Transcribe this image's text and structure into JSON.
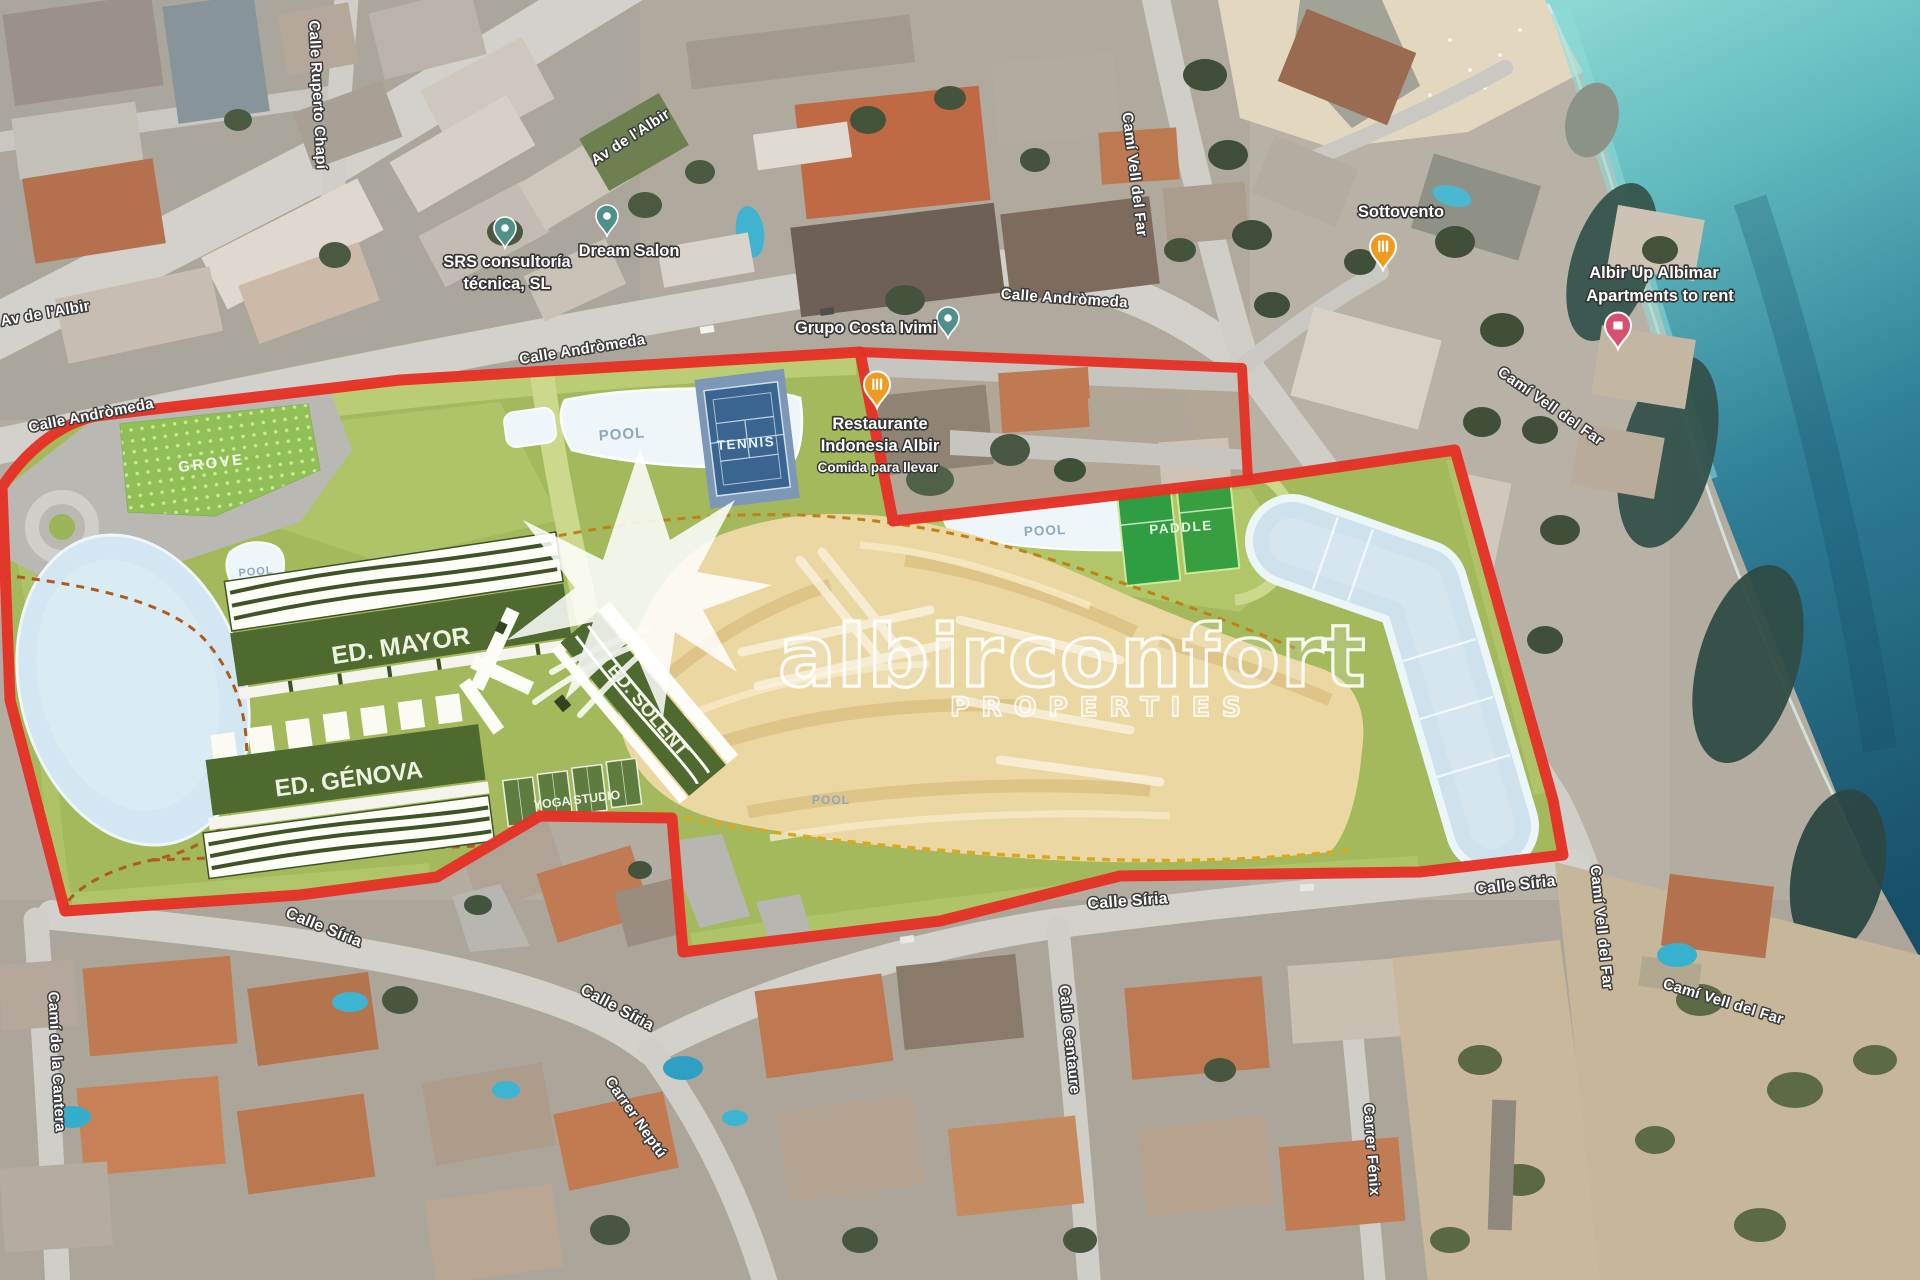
{
  "brand": {
    "word1": "albir",
    "word2": "confort",
    "tagline": "PROPERTIES"
  },
  "plan_labels": {
    "grove": "GROVE",
    "pool": "POOL",
    "tennis": "TENNIS",
    "paddle": "PADDLE",
    "ed_mayor": "ED. MAYOR",
    "ed_genova": "ED. GÉNOVA",
    "ed_solent": "ED. SOLENT",
    "yoga_studio": "YOGA STUDIO"
  },
  "streets": {
    "av_albir": "Av de l'Albir",
    "ruperto_chapi": "Calle Ruperto Chapí",
    "andromeda": "Calle Andròmeda",
    "cami_vell_del_far": "Camí Vell del Far",
    "siria": "Calle Síria",
    "neptu": "Carrer Neptú",
    "centaure": "Calle Centaure",
    "fenix": "Carrer Fénix",
    "cantera": "Camí de la Cantera"
  },
  "pois": {
    "srs": {
      "line1": "SRS consultoría",
      "line2": "técnica, SL"
    },
    "dream_salon": "Dream Salon",
    "grupo_costa": "Grupo Costa Ivimi",
    "restaurante": {
      "line1": "Restaurante",
      "line2": "Indonesia Albir",
      "line3": "Comida para llevar"
    },
    "sottovento": "Sottovento",
    "albimar": {
      "line1": "Albir Up Albimar",
      "line2": "Apartments to rent"
    }
  },
  "colors": {
    "boundary_red": "#e53125",
    "plan_green": "#a3b95c",
    "tan_zone": "#ead7a2",
    "water_light": "#d2e7f1",
    "tennis_blue": "#3a6591",
    "paddle_green": "#2f9e42",
    "sea_deep": "#174f68"
  }
}
